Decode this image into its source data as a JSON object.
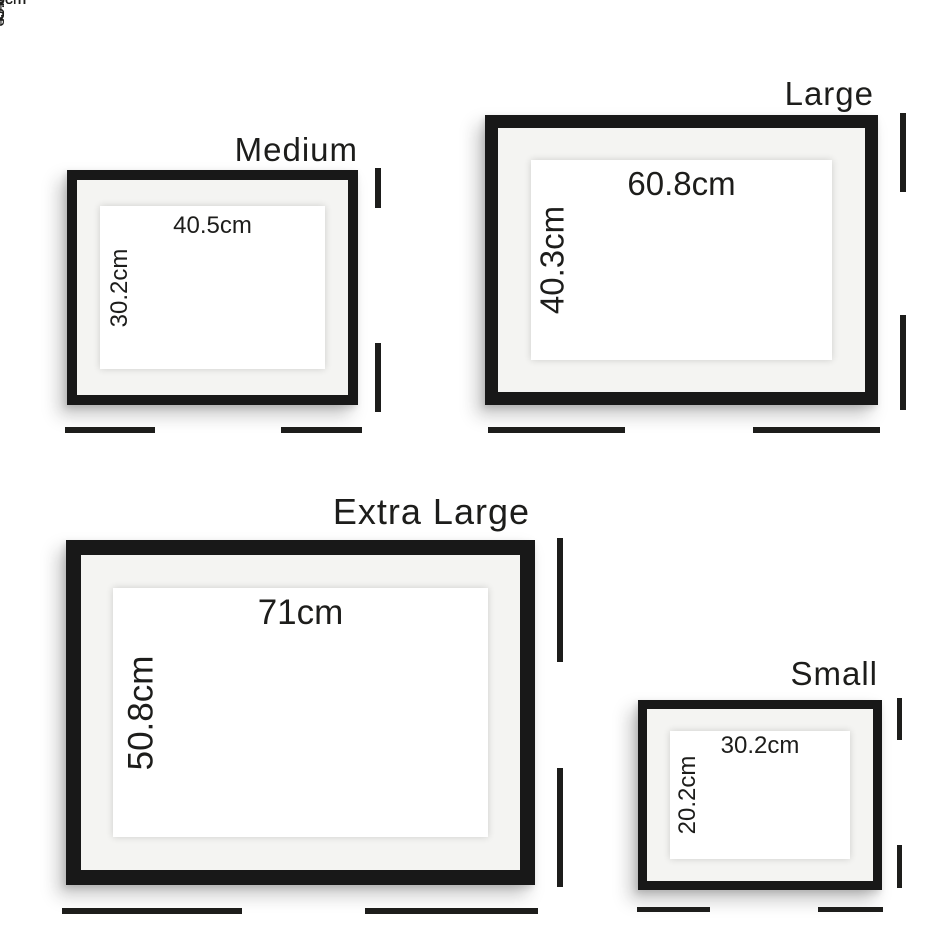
{
  "colors": {
    "background": "#ffffff",
    "frame": "#181818",
    "mat": "#f4f4f2",
    "paper": "#ffffff",
    "line": "#1d1d1b",
    "text": "#1d1d1b"
  },
  "frames": [
    {
      "name": "Medium",
      "opening_width": "40.5cm",
      "opening_height": "30.2cm",
      "outer_width": "53.8cm",
      "outer_height": "43.6cm"
    },
    {
      "name": "Large",
      "opening_width": "60.8cm",
      "opening_height": "40.3cm",
      "outer_width": "74.3cm",
      "outer_height": "54cm"
    },
    {
      "name": "Extra Large",
      "opening_width": "71cm",
      "opening_height": "50.8cm",
      "outer_width": "84.3cm",
      "outer_height": "64cm"
    },
    {
      "name": "Small",
      "opening_width": "30.2cm",
      "opening_height": "20.2cm",
      "outer_width": "43.6cm",
      "outer_height": "33.5cm"
    }
  ]
}
